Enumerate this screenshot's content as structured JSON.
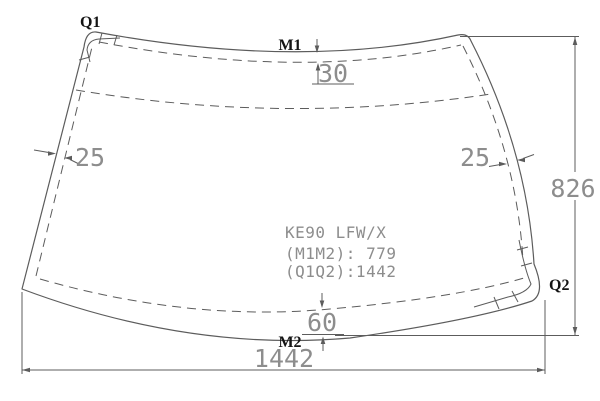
{
  "drawing_title": "Windshield dimension drawing",
  "labels": {
    "q1": "Q1",
    "m1": "M1",
    "m2": "M2",
    "q2": "Q2"
  },
  "dimensions": {
    "top_band": "30",
    "left_band": "25",
    "right_band": "25",
    "bottom_band": "60",
    "overall_height": "826",
    "overall_width": "1442"
  },
  "part_info": {
    "model": "KE90 LFW/X",
    "m1_m2": "(M1M2): 779",
    "q1_q2": "(Q1Q2):1442"
  },
  "colors": {
    "line": "#5c5c5c",
    "dim_text": "#8d8d8d",
    "label_text": "#141414",
    "bg": "#ffffff"
  }
}
